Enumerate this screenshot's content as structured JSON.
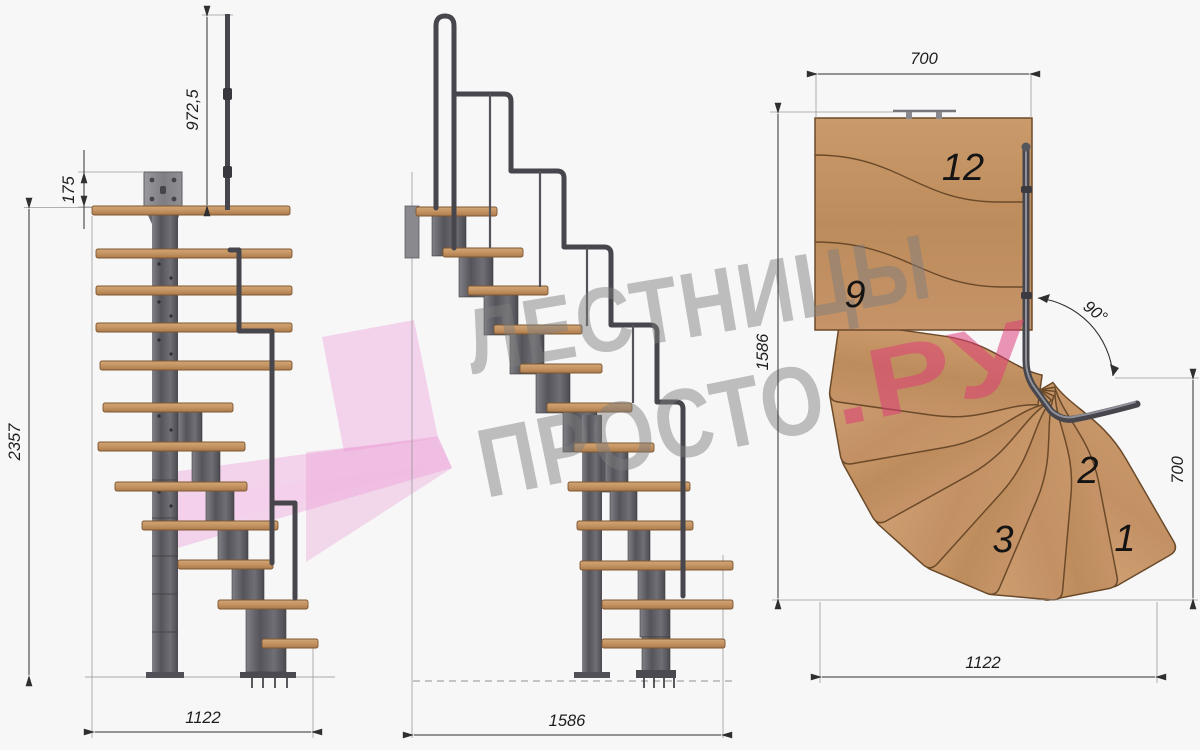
{
  "drawing": {
    "description": "Modular staircase technical drawing with 90 degree turn, three views",
    "front_view": {
      "dims": {
        "handrail_height": "972,5",
        "plate_height": "175",
        "total_height": "2357",
        "base_width": "1122"
      }
    },
    "side_view": {
      "dims": {
        "total_length": "1586"
      }
    },
    "plan_view": {
      "dims": {
        "landing_width": "700",
        "total_length": "1586",
        "turn_angle": "90°",
        "entry_width": "700",
        "total_width": "1122"
      },
      "step_labels": {
        "s12": "12",
        "s9": "9",
        "s3": "3",
        "s2": "2",
        "s1": "1"
      }
    },
    "watermark": {
      "line1": "ЛЕСТНИЦЫ",
      "line2_gray": "ПРОСТО",
      "line2_accent": ".РУ",
      "accent_color": "#de3a76",
      "gray_color": "#7d7d7d",
      "logo_pink": "#eea2d8"
    },
    "colors": {
      "wood": "#c79a6d",
      "wood_edge": "#6b4a2a",
      "metal": "#5a5a5e",
      "metal_dark": "#3e3e42",
      "dim_lines": "#2f2f2f"
    }
  }
}
